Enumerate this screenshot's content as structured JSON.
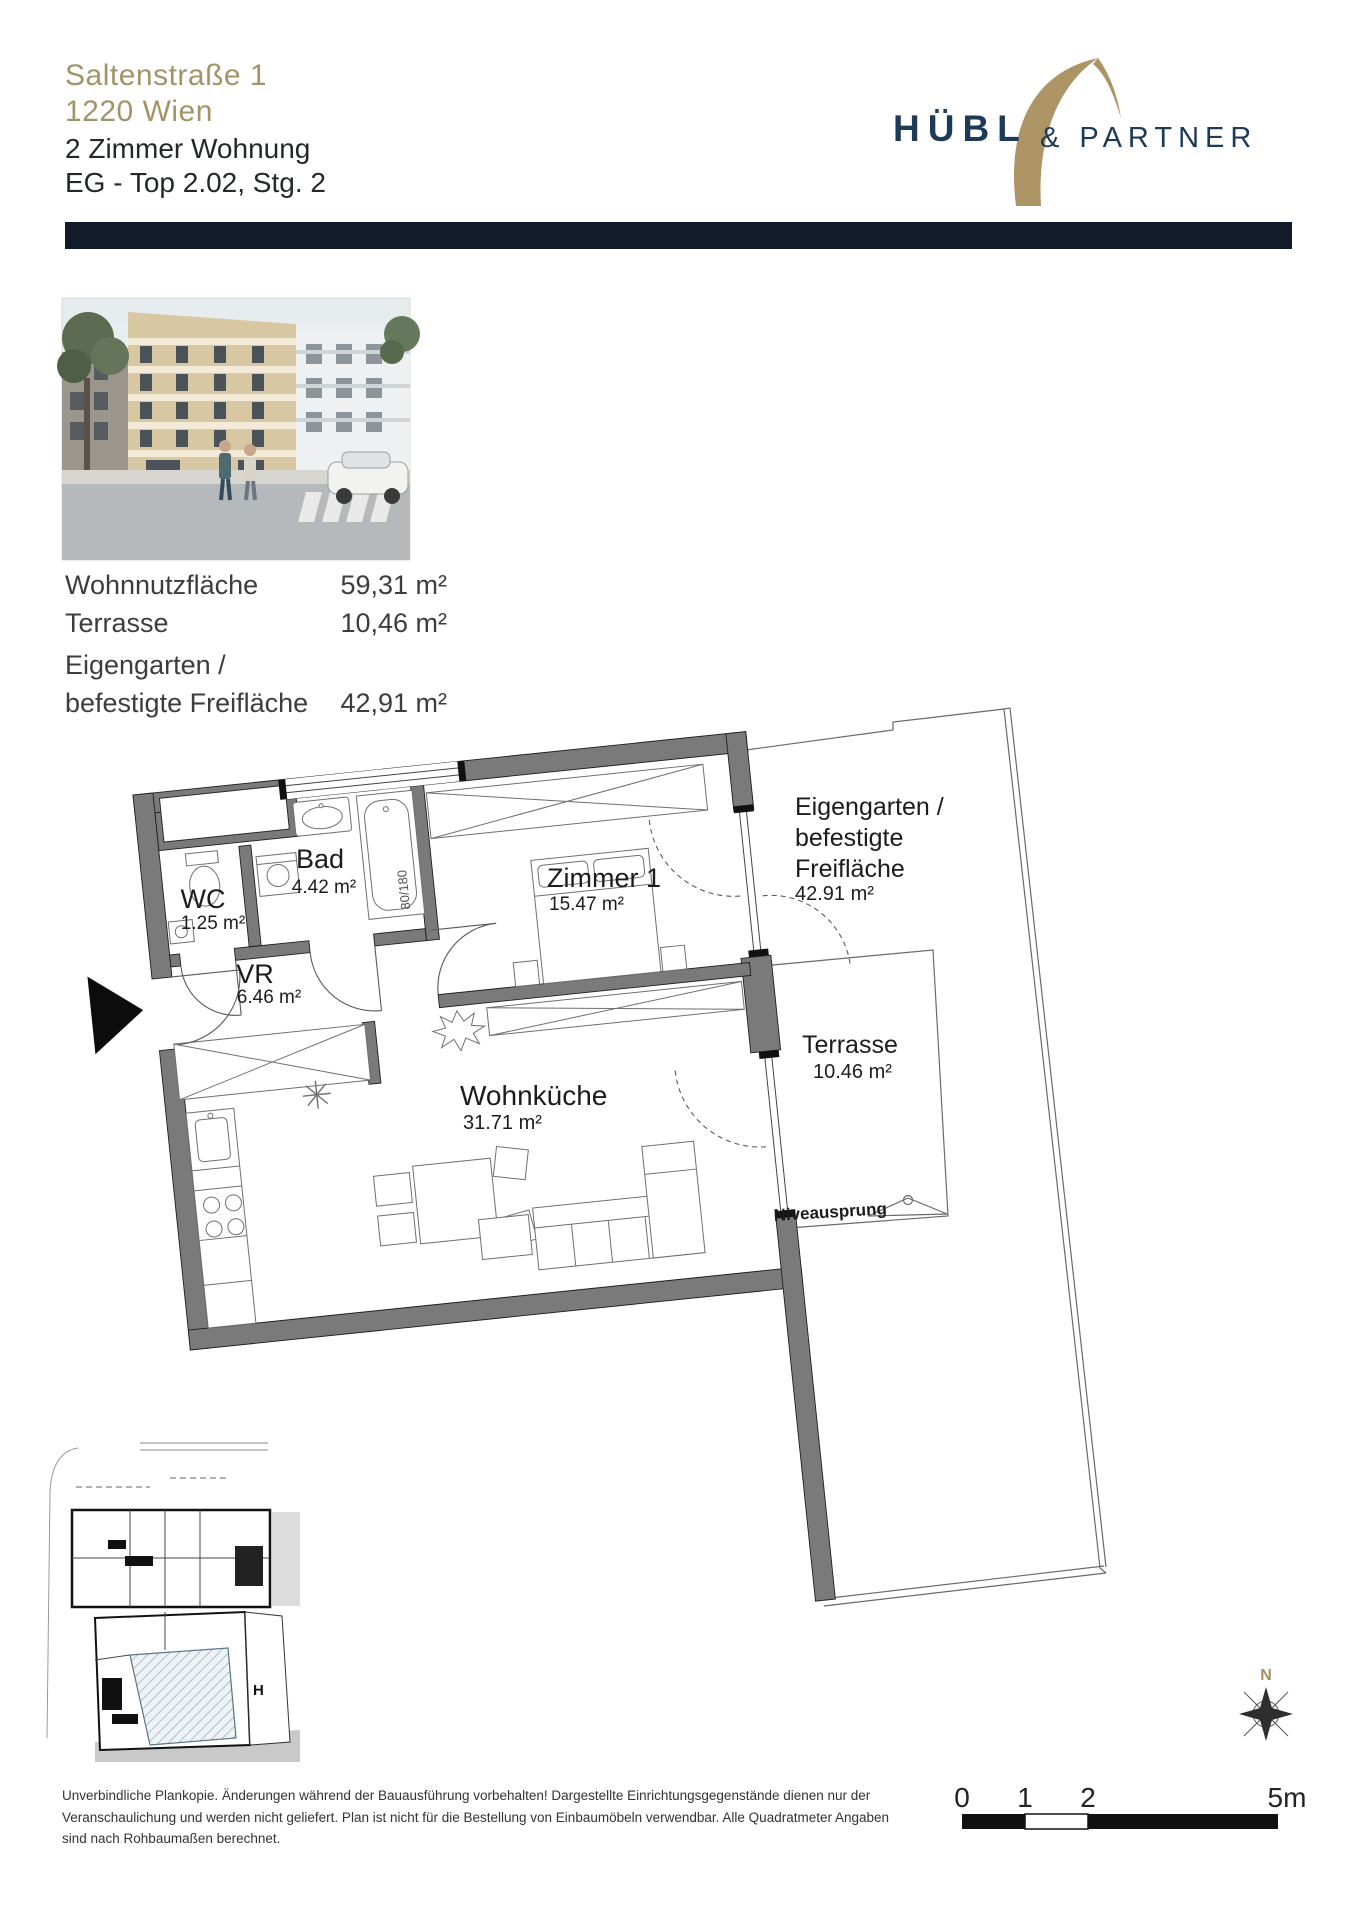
{
  "header": {
    "address_line1": "Saltenstraße 1",
    "address_line2": "1220 Wien",
    "unit_line1": "2 Zimmer Wohnung",
    "unit_line2": "EG - Top 2.02, Stg. 2"
  },
  "logo": {
    "word1": "HÜBL",
    "word2": "& PARTNER",
    "gold": "#ac9464",
    "navy": "#1d3a57"
  },
  "area_table": {
    "rows": [
      {
        "label": "Wohnnutzfläche",
        "value": "59,31 m²"
      },
      {
        "label": "Terrasse",
        "value": "10,46 m²"
      },
      {
        "label_line1": "Eigengarten /",
        "label_line2": "befestigte Freifläche",
        "value": "42,91 m²"
      }
    ]
  },
  "floor_plan": {
    "rooms": [
      {
        "name": "Bad",
        "area": "4.42 m²"
      },
      {
        "name": "WC",
        "area": "1.25 m²"
      },
      {
        "name": "VR",
        "area": "6.46 m²"
      },
      {
        "name": "Zimmer 1",
        "area": "15.47 m²"
      },
      {
        "name": "Wohnküche",
        "area": "31.71 m²"
      }
    ],
    "outdoor": {
      "garden_line1": "Eigengarten /",
      "garden_line2": "befestigte",
      "garden_line3": "Freifläche",
      "garden_area": "42.91 m²",
      "terrace_name": "Terrasse",
      "terrace_area": "10.46 m²",
      "level_jump": "Niveausprung"
    },
    "bathtub_label": "80/180",
    "wall_color": "#7a7a7a"
  },
  "site_plan": {
    "marker": "H"
  },
  "compass": {
    "north": "N"
  },
  "scale_bar": {
    "tick0": "0",
    "tick1": "1",
    "tick2": "2",
    "tick_end": "5m"
  },
  "disclaimer": {
    "line1": "Unverbindliche Plankopie. Änderungen während der Bauausführung vorbehalten! Dargestellte Einrichtungsgegenstände dienen nur der",
    "line2": "Veranschaulichung und werden nicht geliefert. Plan ist nicht für die Bestellung von Einbaumöbeln verwendbar. Alle Quadratmeter Angaben",
    "line3": "sind nach Rohbaumaßen berechnet."
  }
}
